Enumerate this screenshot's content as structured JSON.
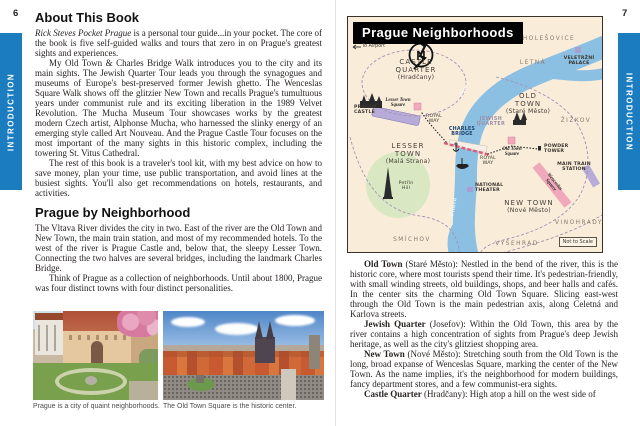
{
  "pages": {
    "left_number": "6",
    "right_number": "7"
  },
  "sidebar": {
    "label": "INTRODUCTION"
  },
  "colors": {
    "accent_blue": "#1b7cc0",
    "map_background": "#f9edda",
    "map_river": "#8cc0e2",
    "map_park_green": "#d9e8c3",
    "map_highlight_pink": "#f2a9bc",
    "map_landmark_lavender": "#b7abd8"
  },
  "left_page": {
    "section1_title": "About This Book",
    "p1_italic": "Rick Steves Pocket Prague",
    "p1_rest": " is a personal tour guide...in your pocket. The core of the book is five self-guided walks and tours that zero in on Prague's greatest sights and experiences.",
    "p2": "My Old Town & Charles Bridge Walk introduces you to the city and its main sights. The Jewish Quarter Tour leads you through the synagogues and museums of Europe's best-preserved former Jewish ghetto. The Wenceslas Square Walk shows off the glitzier New Town and recalls Prague's tumultuous years under communist rule and its exciting liberation in the 1989 Velvet Revolution. The Mucha Museum Tour showcases works by the greatest modern Czech artist, Alphonse Mucha, who harnessed the slinky energy of an emerging style called Art Nouveau. And the Prague Castle Tour focuses on the most important of the many sights in this historic complex, including the towering St. Vitus Cathedral.",
    "p3": "The rest of this book is a traveler's tool kit, with my best advice on how to save money, plan your time, use public transportation, and avoid lines at the busiest sights. You'll also get recommendations on hotels, restaurants, and activities.",
    "section2_title": "Prague by Neighborhood",
    "p4": "The Vltava River divides the city in two. East of the river are the Old Town and New Town, the main train station, and most of my recommended hotels. To the west of the river is Prague Castle and, below that, the sleepy Lesser Town. Connecting the two halves are several bridges, including the landmark Charles Bridge.",
    "p5": "Think of Prague as a collection of neighborhoods. Until about 1800, Prague was four distinct towns with four distinct personalities.",
    "caption1": "Prague is a city of quaint neighborhoods.",
    "caption2": "The Old Town Square is the historic center."
  },
  "map": {
    "title": "Prague Neighborhoods",
    "compass": "N",
    "icons": {
      "airport_arrow": "←"
    },
    "to_airport": "To Airport",
    "holesovice": "HOLEŠOVICE",
    "veletrzni_palace": "VELETRŽNÍ PALACE",
    "letna": "LETNÁ",
    "castle_quarter_name": "CASTLE QUARTER",
    "castle_quarter_sub": "(Hradčany)",
    "prague_castle": "PRAGUE CASTLE",
    "lesser_town_square": "Lesser Town Square",
    "royal_way": "ROYAL WAY",
    "charles_bridge": "CHARLES BRIDGE",
    "lesser_town_name": "LESSER TOWN",
    "lesser_town_sub": "(Malá Strana)",
    "petrin_hill": "Petřín Hill",
    "old_town_name": "OLD TOWN",
    "old_town_sub": "(Staré Město)",
    "jewish_quarter": "JEWISH QUARTER",
    "old_town_square": "Old Town Square",
    "powder_tower": "POWDER TOWER",
    "zizkov": "ŽIŽKOV",
    "main_train_station": "MAIN TRAIN STATION",
    "wenceslas_square": "Wenceslas Square",
    "national_theater": "NATIONAL THEATER",
    "new_town_name": "NEW TOWN",
    "new_town_sub": "(Nové Město)",
    "vinohrady": "VINOHRADY",
    "vysehrad": "VYŠEHRAD",
    "smichov": "SMÍCHOV",
    "vltava_word1": "Vltava",
    "vltava_word2": "River",
    "not_to_scale": "Not to Scale"
  },
  "right_page": {
    "neighborhoods": [
      {
        "name": "Old Town",
        "text": " (Staré Město): Nestled in the bend of the river, this is the historic core, where most tourists spend their time. It's pedestrian-friendly, with small winding streets, old buildings, shops, and beer halls and cafés. In the center sits the charming Old Town Square. Slicing east-west through the Old Town is the main pedestrian axis, along Celetná and Karlova streets."
      },
      {
        "name": "Jewish Quarter",
        "text": " (Josefov): Within the Old Town, this area by the river contains a high concentration of sights from Prague's deep Jewish heritage, as well as the city's glitziest shopping area."
      },
      {
        "name": "New Town",
        "text": " (Nové Město): Stretching south from the Old Town is the long, broad expanse of Wenceslas Square, marking the center of the New Town. As the name implies, it's the neighborhood for modern buildings, fancy department stores, and a few communist-era sights."
      },
      {
        "name": "Castle Quarter",
        "text": " (Hradčany): High atop a hill on the west side of"
      }
    ]
  }
}
